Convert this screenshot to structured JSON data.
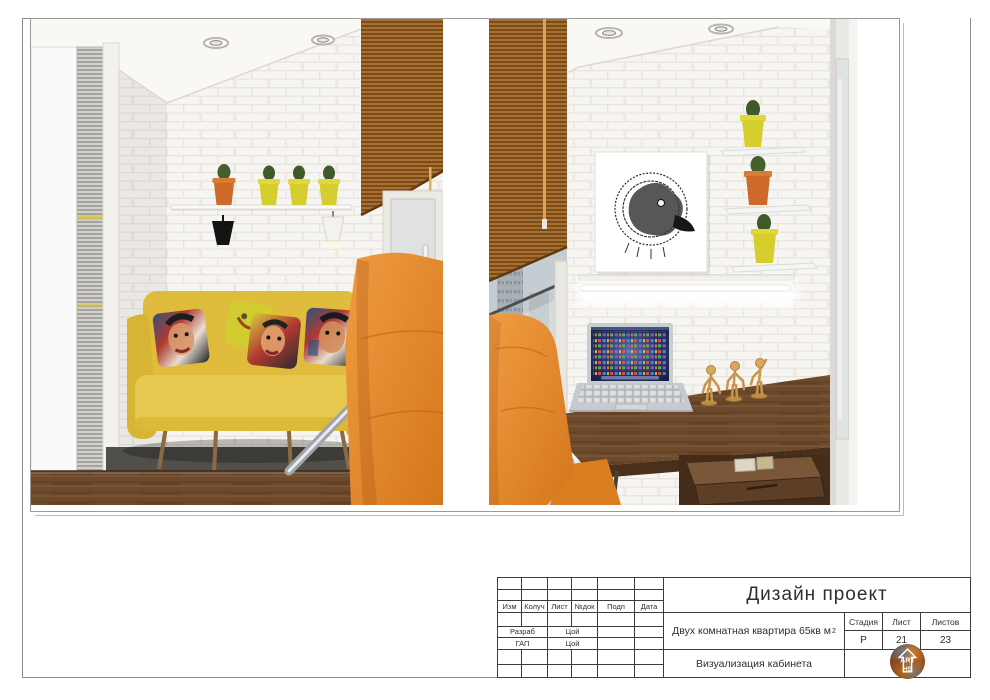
{
  "title_block": {
    "project_type": "Дизайн проект",
    "object_name": "Двух комнатная квартира 65кв м",
    "object_area_sup": "2",
    "drawing_title": "Визуализация кабинета",
    "columns": [
      "Изм",
      "Колуч",
      "Лист",
      "№док",
      "Подп",
      "Дата"
    ],
    "signature_rows": [
      {
        "role": "Разраб",
        "name": "Цой"
      },
      {
        "role": "ГАП",
        "name": "Цой"
      }
    ],
    "stage": {
      "label": "Стадия",
      "value": "Р"
    },
    "sheet": {
      "label": "Лист",
      "value": "21"
    },
    "sheets": {
      "label": "Листов",
      "value": "23"
    },
    "logo": {
      "line1": "ART",
      "line2": "HS"
    },
    "line_color": "#3c3c3c"
  },
  "renders": {
    "left_render": {
      "subject": "balcony-lounge-visualization",
      "colors": {
        "wall_brick": "#f6f4f1",
        "sofa_yellow": "#e0be3f",
        "chair_orange": "#e0812a",
        "blinds_brown": "#a8702f",
        "pot_orange": "#cd6a2a",
        "pot_yellow": "#d6cd2e",
        "desk_wood": "#7a5433",
        "floor_gray": "#514f4b"
      }
    },
    "right_render": {
      "subject": "home-office-visualization",
      "colors": {
        "wall_brick": "#f6f4f1",
        "blinds_brown": "#a8702f",
        "chair_orange": "#e0812a",
        "desk_wood": "#7a5433",
        "laptop_silver": "#c6c9cd",
        "screen_navy": "#1c2747",
        "mannequin_tan": "#d8a95c",
        "pot_orange": "#cd6a2a",
        "pot_yellow": "#d6cd2e"
      }
    }
  }
}
